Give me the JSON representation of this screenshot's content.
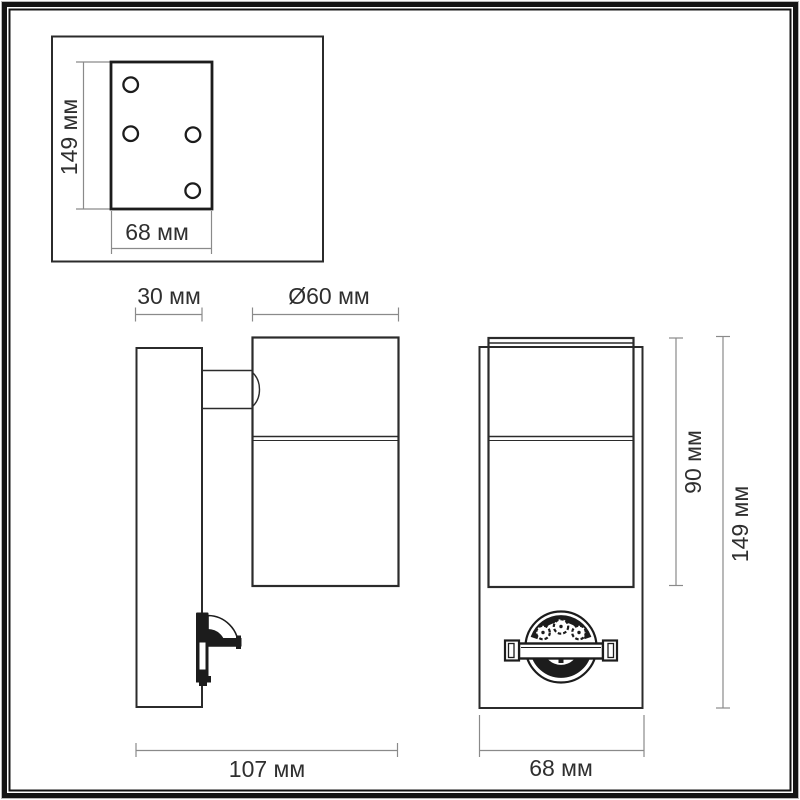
{
  "drawing": {
    "units": "мм",
    "plate_view": {
      "height_label": "149 мм",
      "width_label": "68 мм",
      "hole_count": 4
    },
    "side_view": {
      "backplate_depth_label": "30 мм",
      "body_diameter_label": "Ø60 мм",
      "overall_depth_label": "107 мм"
    },
    "front_view": {
      "body_height_label": "90 мм",
      "overall_height_label": "149 мм",
      "width_label": "68 мм"
    },
    "colors": {
      "outline": "#2b2b2b",
      "heavy_outline": "#1c1c1c",
      "dimension_line": "#8a8a8a",
      "text": "#2f2f2f",
      "background": "#ffffff",
      "frame": "#141414",
      "frame_hairline": "#b8b8b8"
    }
  }
}
